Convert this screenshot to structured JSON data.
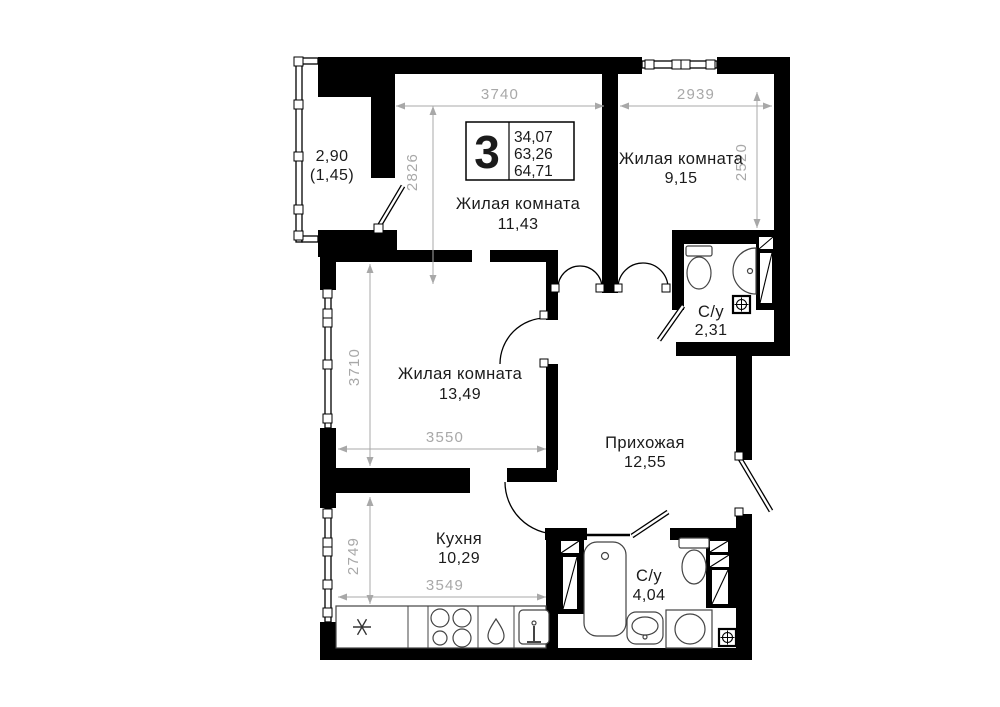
{
  "plan": {
    "info_badge": {
      "room_count": "3",
      "living_area": "34,07",
      "area": "63,26",
      "total_area": "64,71"
    },
    "rooms": {
      "living1": {
        "name": "Жилая комната",
        "area": "11,43"
      },
      "living2": {
        "name": "Жилая комната",
        "area": "9,15"
      },
      "living3": {
        "name": "Жилая комната",
        "area": "13,49"
      },
      "kitchen": {
        "name": "Кухня",
        "area": "10,29"
      },
      "hallway": {
        "name": "Прихожая",
        "area": "12,55"
      },
      "bathroom1": {
        "name": "С/у",
        "area": "2,31"
      },
      "bathroom2": {
        "name": "С/у",
        "area": "4,04"
      },
      "balcony": {
        "area": "2,90",
        "area_reduced": "(1,45)"
      }
    },
    "dimensions_mm": {
      "living1_width": "3740",
      "living1_depth": "2826",
      "living2_width": "2939",
      "living2_depth": "2520",
      "living3_depth": "3710",
      "living3_width": "3550",
      "kitchen_depth": "2749",
      "kitchen_width": "3549"
    },
    "colors": {
      "wall": "#000000",
      "dimension": "#a8a8a8",
      "label": "#1b1b1b",
      "background": "#ffffff"
    }
  }
}
